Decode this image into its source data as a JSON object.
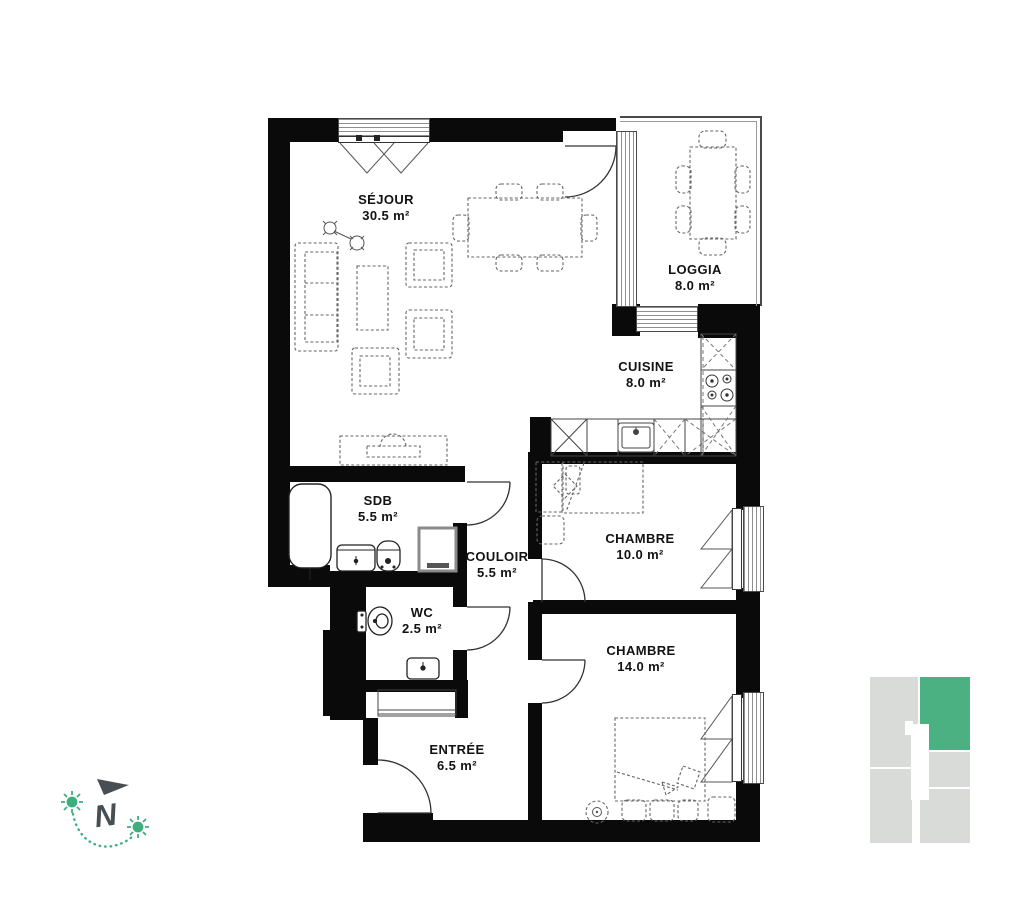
{
  "rooms": [
    {
      "id": "sejour",
      "name": "SÉJOUR",
      "area": "30.5 m²"
    },
    {
      "id": "loggia",
      "name": "LOGGIA",
      "area": "8.0 m²"
    },
    {
      "id": "cuisine",
      "name": "CUISINE",
      "area": "8.0 m²"
    },
    {
      "id": "sdb",
      "name": "SDB",
      "area": "5.5 m²"
    },
    {
      "id": "couloir",
      "name": "COULOIR",
      "area": "5.5 m²"
    },
    {
      "id": "wc",
      "name": "WC",
      "area": "2.5 m²"
    },
    {
      "id": "chambre1",
      "name": "CHAMBRE",
      "area": "10.0 m²"
    },
    {
      "id": "chambre2",
      "name": "CHAMBRE",
      "area": "14.0 m²"
    },
    {
      "id": "entree",
      "name": "ENTRÉE",
      "area": "6.5 m²"
    }
  ],
  "compass": {
    "letter": "N"
  },
  "colors": {
    "wall": "#0a0a0a",
    "accent_green": "#4bb182",
    "indicator_gray": "#d9dbd9",
    "compass_dark": "#474f54"
  }
}
